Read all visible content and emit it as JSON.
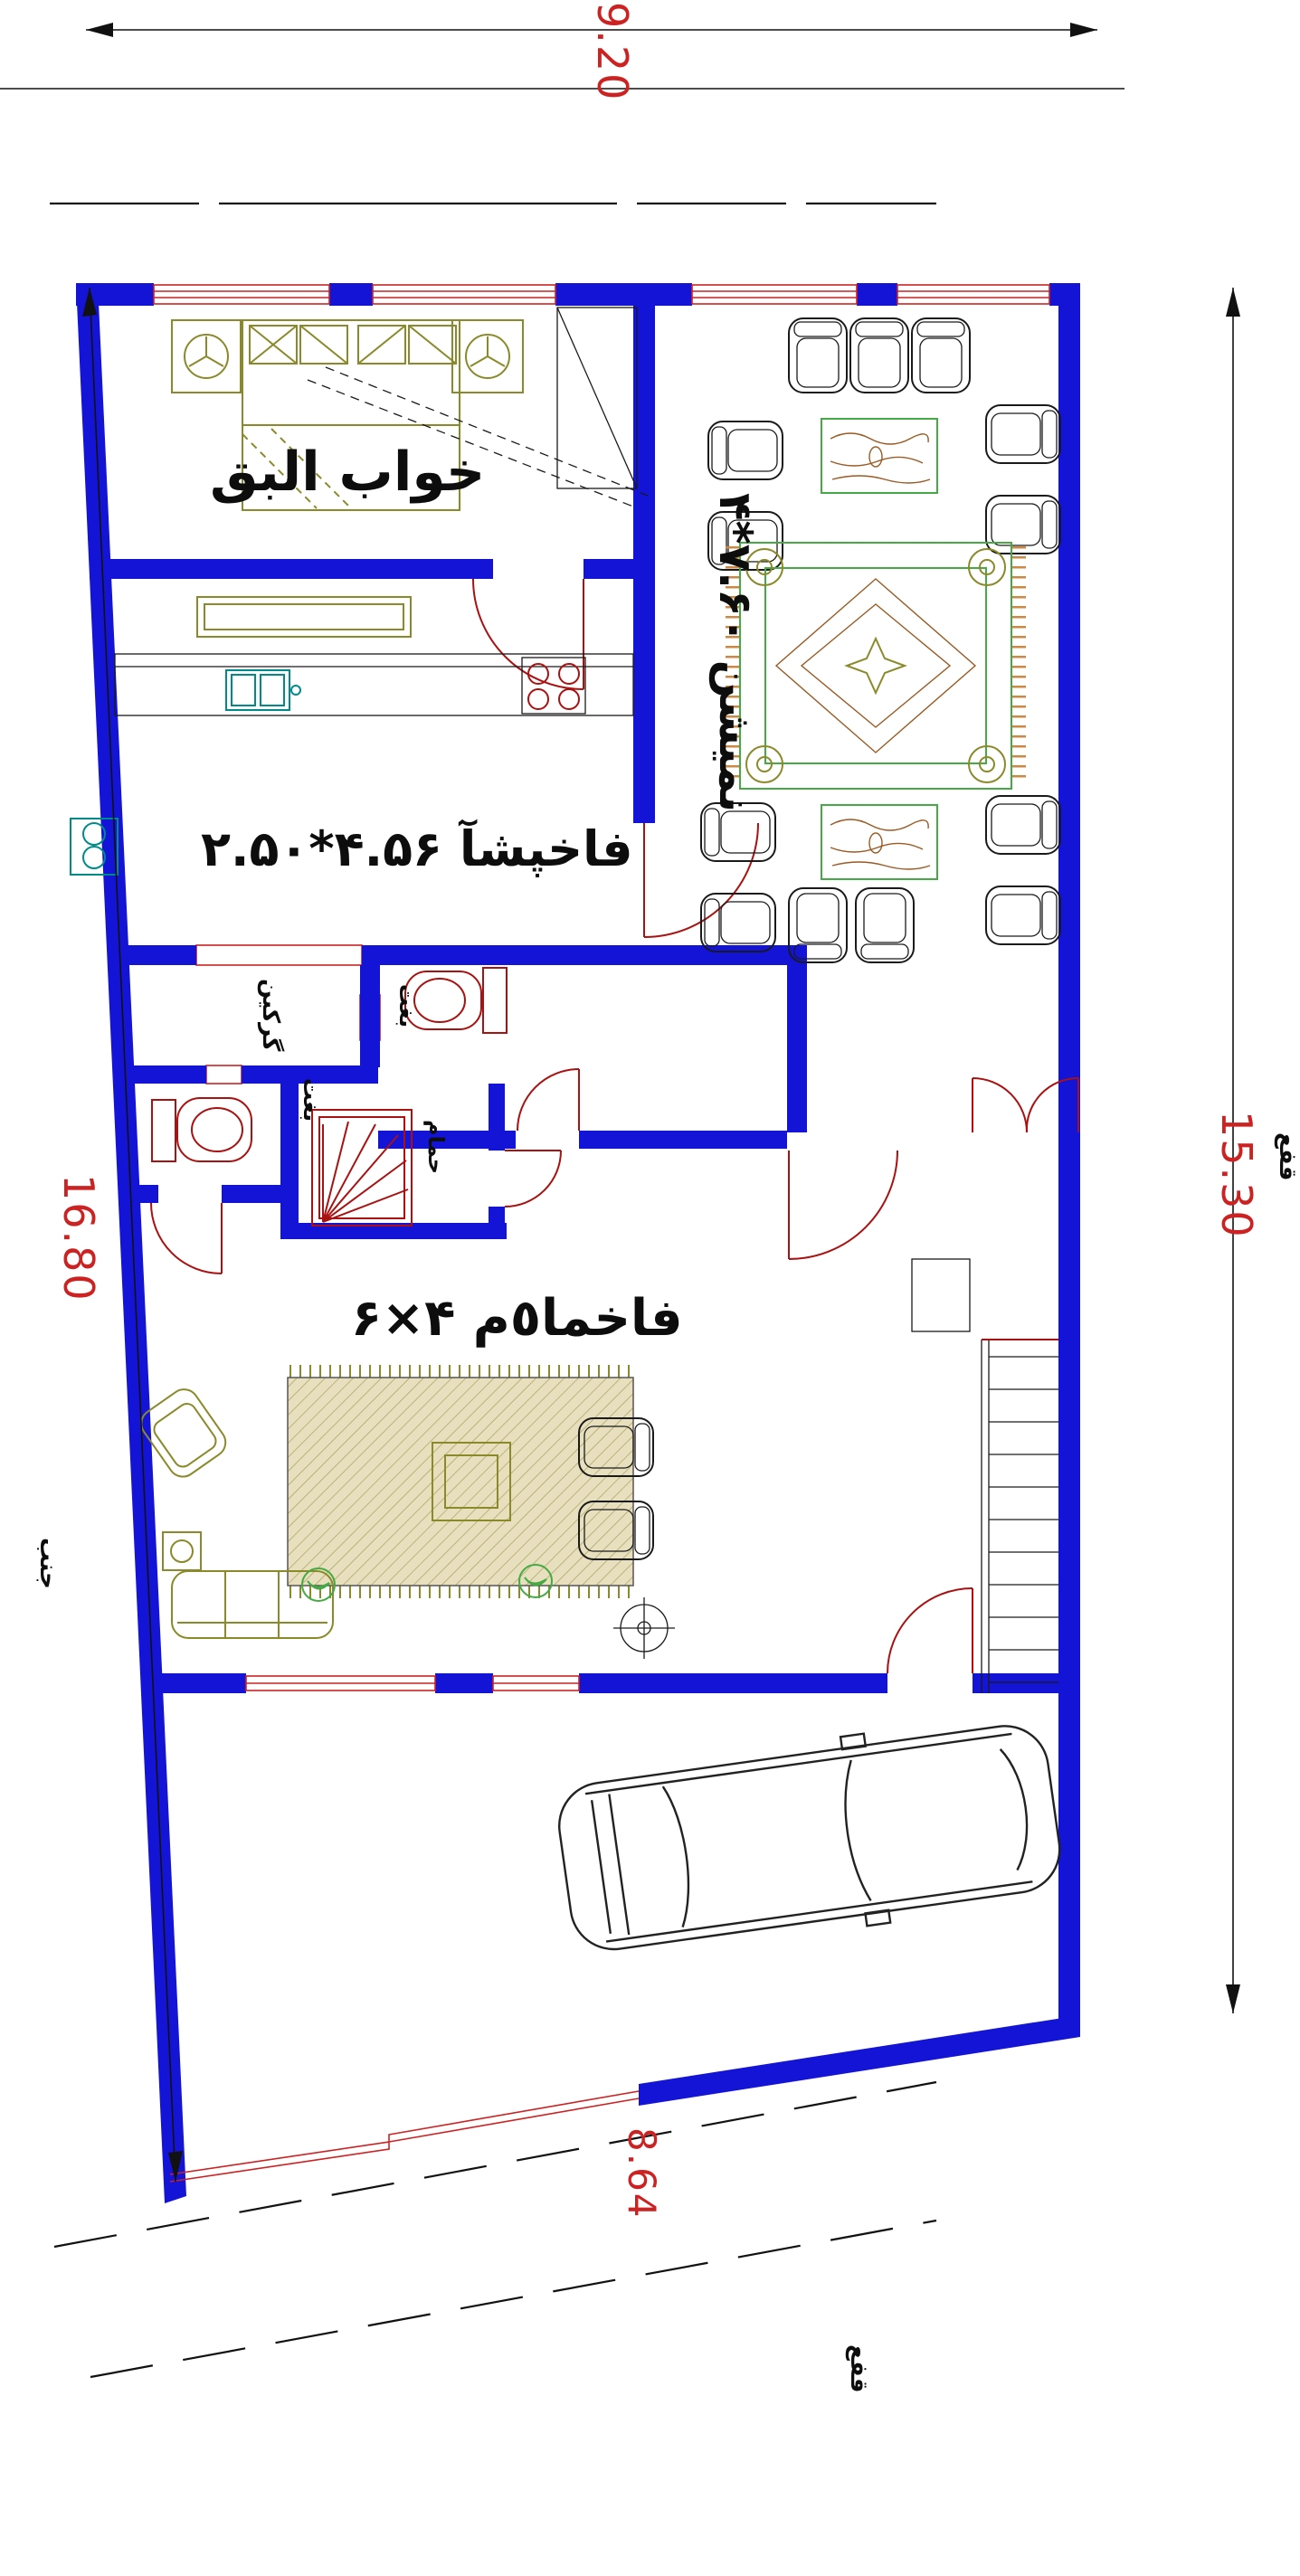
{
  "colors": {
    "wall": "#1414d6",
    "dimred": "#cc2222",
    "fixture": "#aa1111",
    "ruggreen": "#44aa44",
    "olive": "#8a8a2a",
    "teal": "#008b8b",
    "wood": "#9a5a22",
    "fringe": "#cc8844",
    "tan": "#d9d0a8"
  },
  "dimensions": {
    "top": "9.20",
    "right": "15.30",
    "left": "16.80",
    "bottom": "8.64"
  },
  "rooms": {
    "bedroom": {
      "label": "قبلا باوخ"
    },
    "kitchen": {
      "label": "۲.۵۰*۴.۵۶ آشپخاف"
    },
    "living": {
      "label": "۴*۷.۶۰ نشیمن"
    },
    "hall": {
      "label": "۶×۴ م٥امخاف"
    },
    "laundry": {
      "label": "نیکرگ"
    },
    "wc_upper": {
      "label": "تغب"
    },
    "wc_lower": {
      "label": "تغب"
    },
    "shower": {
      "label": "مامح"
    }
  },
  "streets": {
    "right": "عفق",
    "bottom": "عفق",
    "left": "بنج"
  }
}
